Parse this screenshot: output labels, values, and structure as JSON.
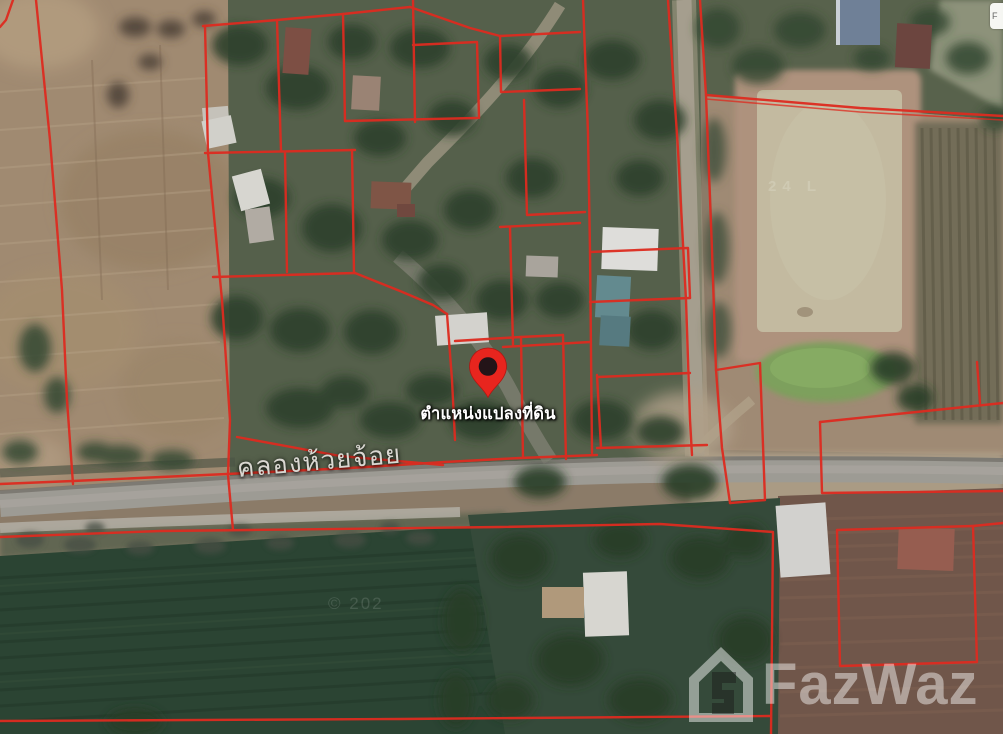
{
  "map": {
    "pin": {
      "label": "ตำแหน่งแปลงที่ดิน",
      "color": "#e8251e",
      "hole_color": "#231418"
    },
    "road_label": "คลองห้วยจ้อย",
    "parcel_line_color": "#e8281c",
    "faint_field_text": "24 L",
    "faint_copyright": "© 202",
    "corner_partial_label": "F"
  },
  "watermark": {
    "brand": "FazWaz",
    "icon": "house-f-icon",
    "color": "#ffffff",
    "opacity": "0.45"
  }
}
